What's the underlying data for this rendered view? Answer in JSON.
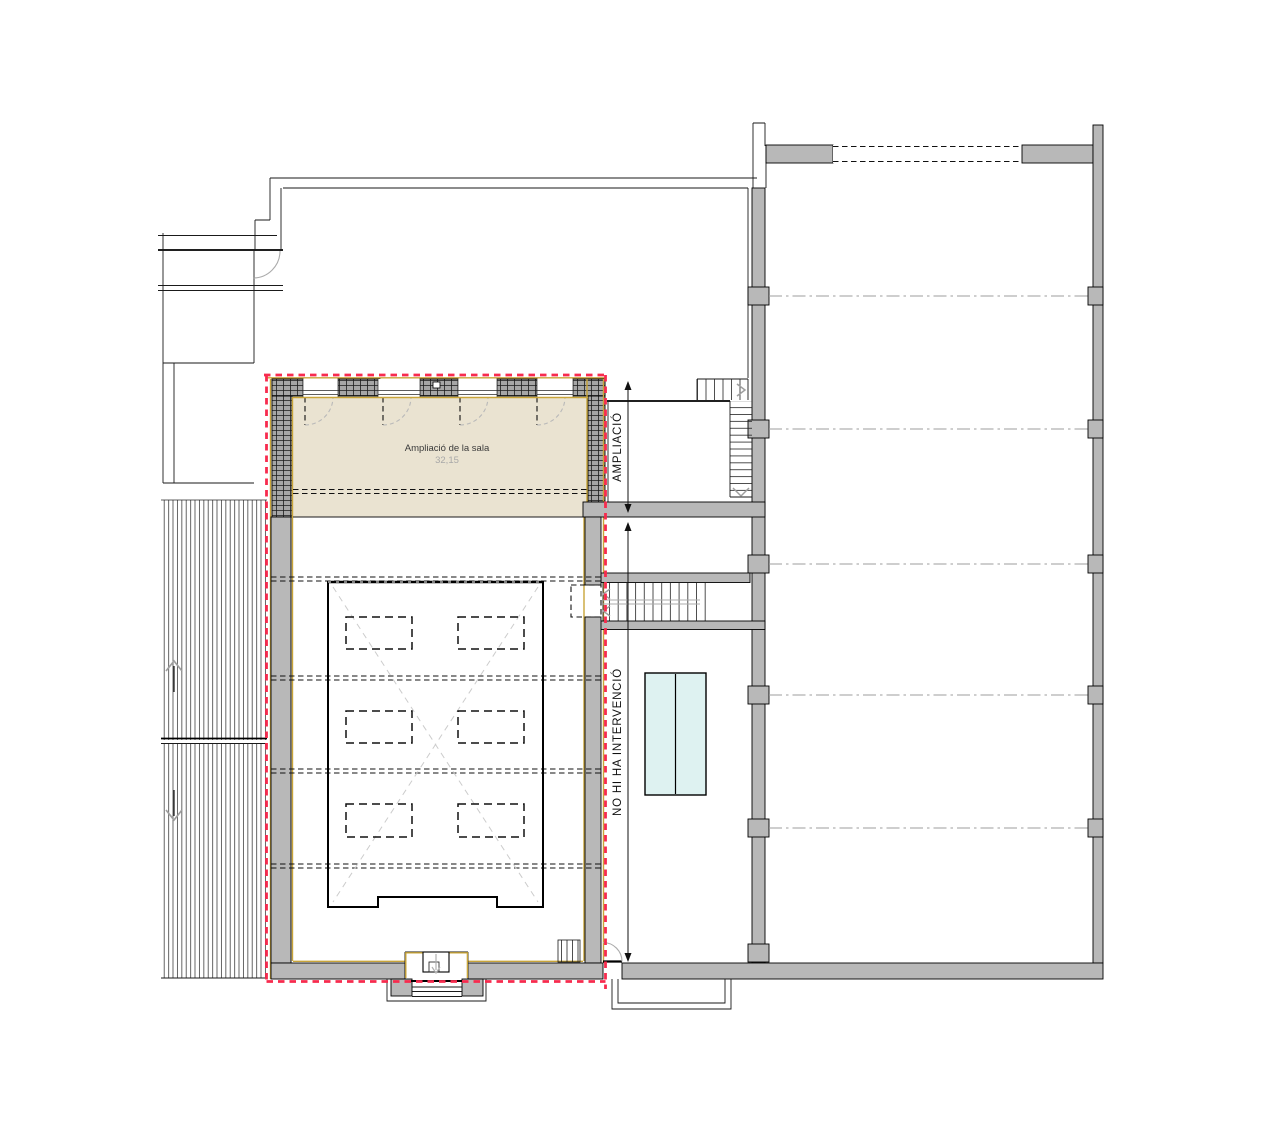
{
  "plan": {
    "type": "architectural-floor-plan",
    "room": {
      "name": "Ampliació de la sala",
      "area": "32,15"
    },
    "dimensions": {
      "ampliacio": "AMPLIACIÓ",
      "no_intervencio": "NO HI HA INTERVENCIÓ"
    },
    "colors": {
      "intervention_outline": "#f72b4e",
      "room_fill": "#eae3d1",
      "wall_fill": "#b8b8b8",
      "finish_line": "#c9a53a",
      "table_fill": "#def2f1",
      "grid_line": "#9d9d9d"
    }
  }
}
